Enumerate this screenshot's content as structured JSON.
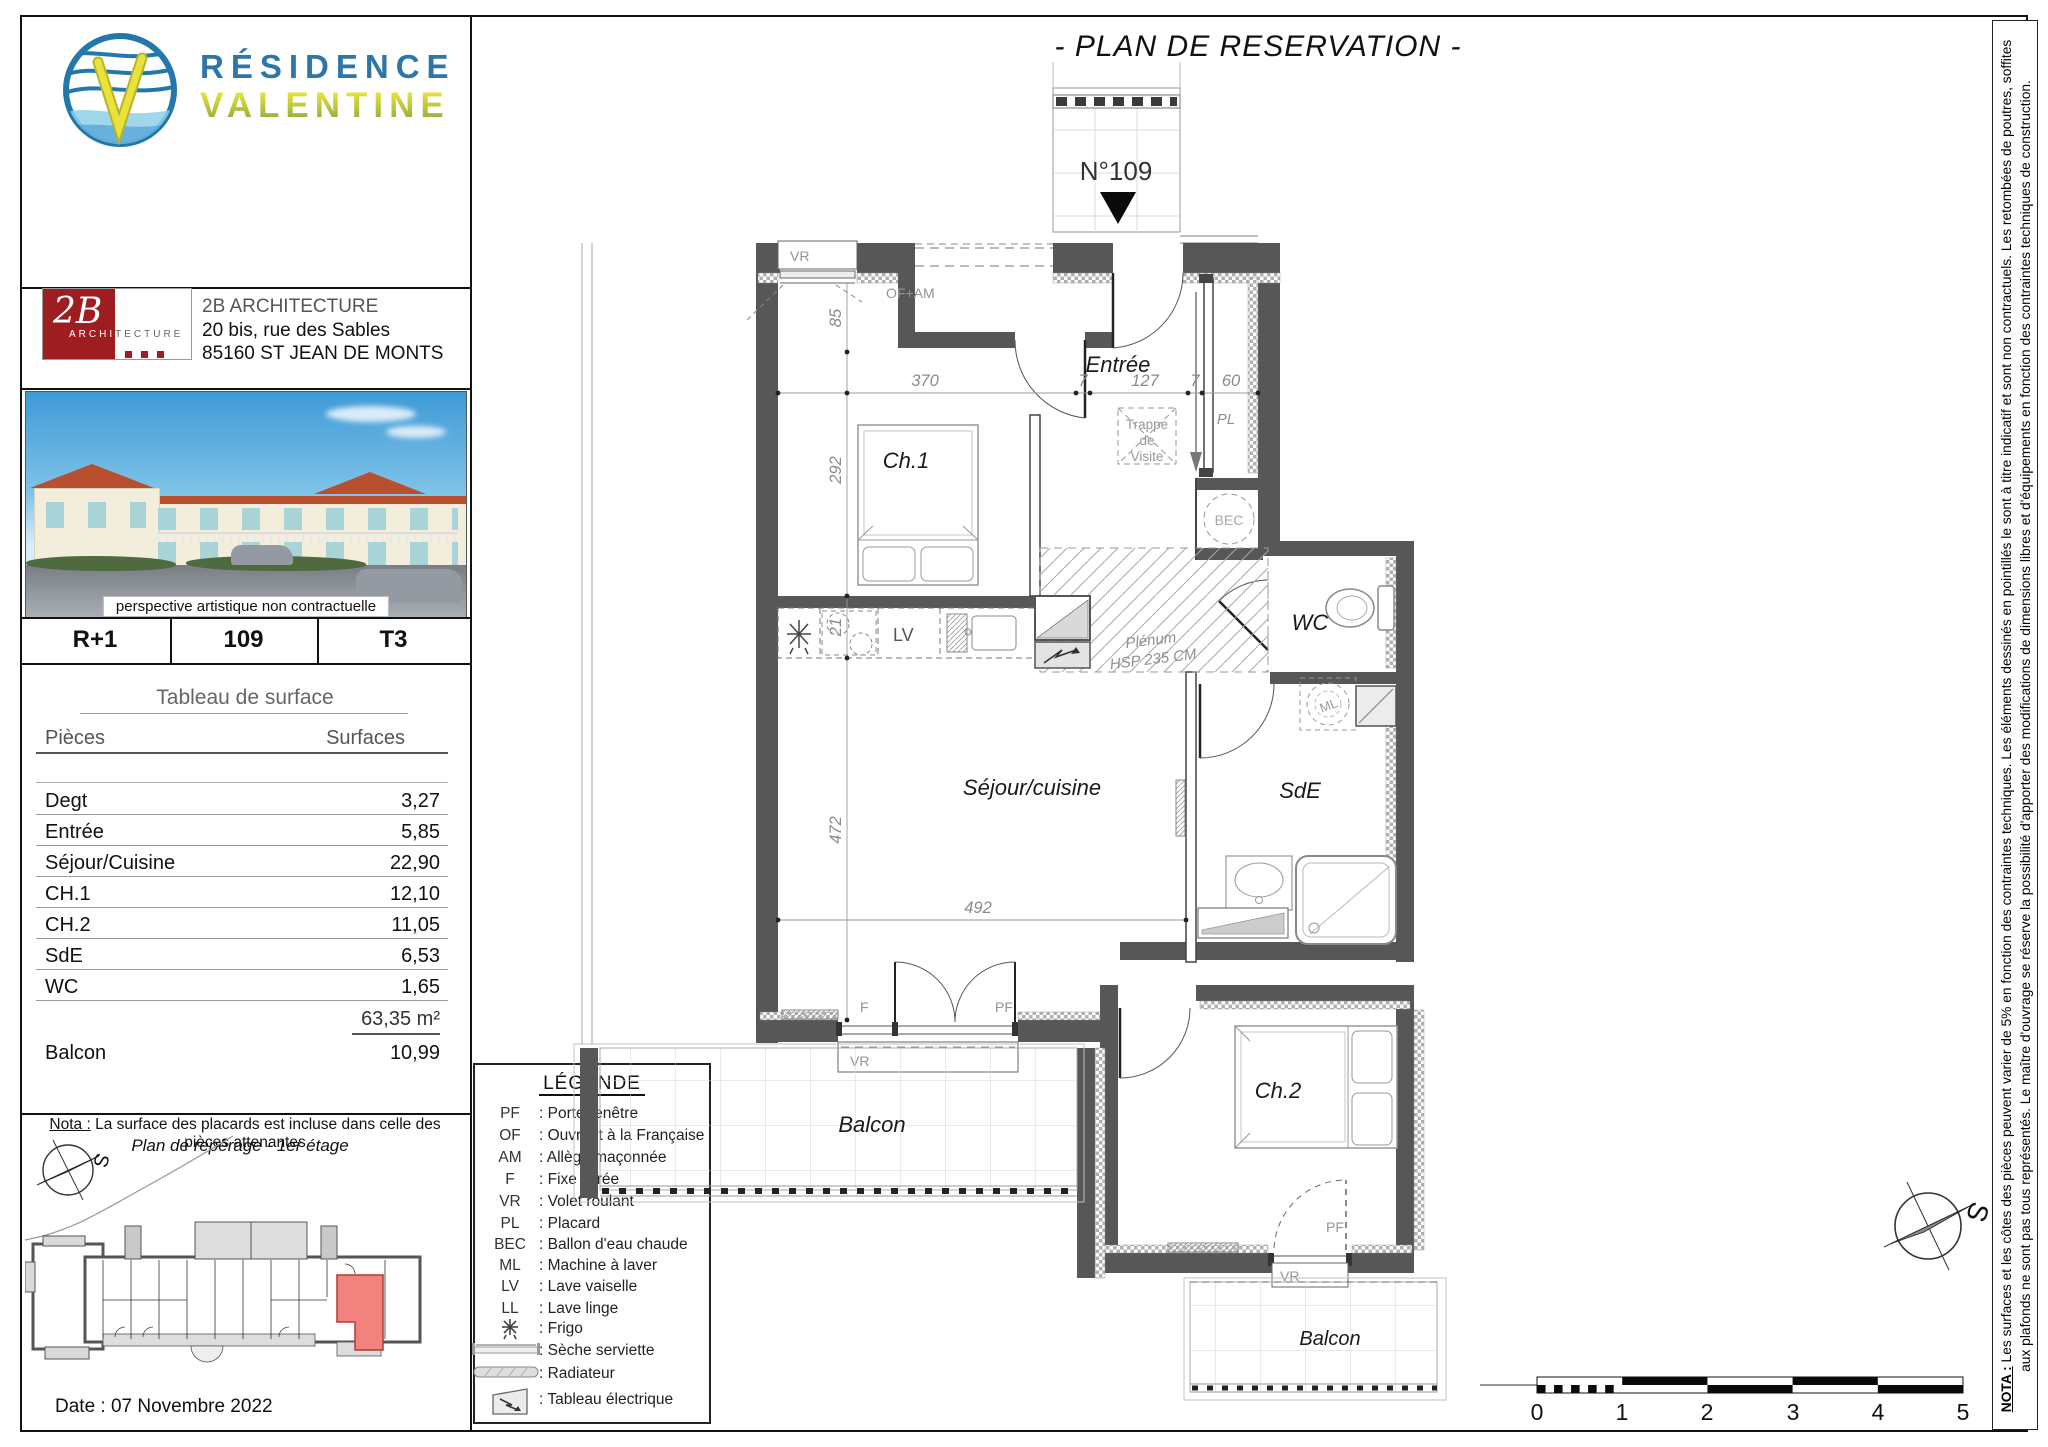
{
  "page": {
    "title": "- PLAN DE RESERVATION -"
  },
  "sidebar": {
    "logo": {
      "line1": "RÉSIDENCE",
      "line2": "VALENTINE"
    },
    "architect": {
      "logo_main": "2B",
      "logo_sub1": "ARCHI",
      "logo_sub2": "TECTURE",
      "name": "2B ARCHITECTURE",
      "address1": "20 bis, rue des Sables",
      "address2": "85160 ST JEAN DE MONTS"
    },
    "photo_caption": "perspective artistique non contractuelle",
    "info": {
      "floor": "R+1",
      "unit": "109",
      "type": "T3"
    },
    "table": {
      "title": "Tableau de surface",
      "col_rooms": "Pièces",
      "col_surfaces": "Surfaces",
      "rows": [
        {
          "label": "Degt",
          "value": "3,27"
        },
        {
          "label": "Entrée",
          "value": "5,85"
        },
        {
          "label": "Séjour/Cuisine",
          "value": "22,90"
        },
        {
          "label": "CH.1",
          "value": "12,10"
        },
        {
          "label": "CH.2",
          "value": "11,05"
        },
        {
          "label": "SdE",
          "value": "6,53"
        },
        {
          "label": "WC",
          "value": "1,65"
        }
      ],
      "total": "63,35 m²",
      "balcony_label": "Balcon",
      "balcony_value": "10,99"
    },
    "nota_label": "Nota :",
    "nota_text": " La surface des placards est incluse dans celle des pièces attenantes",
    "reperage_title": "Plan de repérage - 1er étage",
    "date": "Date :  07 Novembre 2022"
  },
  "legend": {
    "title": "LÉGENDE",
    "items": [
      {
        "abbr": "PF",
        "label": ": Porte-fenêtre"
      },
      {
        "abbr": "OF",
        "label": ": Ouvrant à la Française"
      },
      {
        "abbr": "AM",
        "label": ": Allège maçonnée"
      },
      {
        "abbr": "F",
        "label": ": Fixe vitrée"
      },
      {
        "abbr": "VR",
        "label": ": Volet roulant"
      },
      {
        "abbr": "PL",
        "label": ": Placard"
      },
      {
        "abbr": "BEC",
        "label": ": Ballon d'eau chaude"
      },
      {
        "abbr": "ML",
        "label": ": Machine à laver"
      },
      {
        "abbr": "LV",
        "label": ": Lave vaiselle"
      },
      {
        "abbr": "LL",
        "label": ": Lave linge"
      },
      {
        "abbr": "",
        "label": ": Frigo",
        "icon": "frigo-icon"
      },
      {
        "abbr": "",
        "label": ": Sèche serviette",
        "icon": "towel-dryer-icon"
      },
      {
        "abbr": "",
        "label": ": Radiateur",
        "icon": "radiator-icon"
      },
      {
        "abbr": "",
        "label": ": Tableau électrique",
        "icon": "electrical-panel-icon"
      }
    ]
  },
  "plan": {
    "unit_marker": "N°109",
    "rooms": {
      "entree": "Entrée",
      "ch1": "Ch.1",
      "ch2": "Ch.2",
      "sejour": "Séjour/cuisine",
      "sde": "SdE",
      "wc": "WC",
      "balcon": "Balcon",
      "pl": "PL",
      "bec": "BEC",
      "ml": "ML",
      "lv": "LV"
    },
    "ann": {
      "vr": "VR",
      "of_am": "OF+AM",
      "f": "F",
      "pf": "PF",
      "trappe1": "Trappe",
      "trappe2": "de",
      "trappe3": "Visite",
      "plenum1": "Plénum",
      "plenum2": "HSP 235 CM"
    },
    "dims": {
      "d370": "370",
      "d7": "7",
      "d127": "127",
      "d60": "60",
      "d85": "85",
      "d292": "292",
      "d21": "21",
      "d472": "472",
      "d492": "492"
    },
    "scale": [
      "0",
      "1",
      "2",
      "3",
      "4",
      "5"
    ],
    "compass_s": "S"
  },
  "nota_right": {
    "label": "NOTA :",
    "line1": " Les surfaces et les côtes des pièces peuvent varier de 5% en fonction des contraintes techniques. Les éléments dessinés en pointillés le sont à titre indicatif et sont non contractuels. Les retombées de poutres, soffites",
    "line2": "aux plafonds ne sont pas tous représentés. Le maître d'ouvrage se réserve la possibilité d'apporter des modifications de dimensions libres et d'équipements en fonction des contraintes techniques de construction."
  }
}
